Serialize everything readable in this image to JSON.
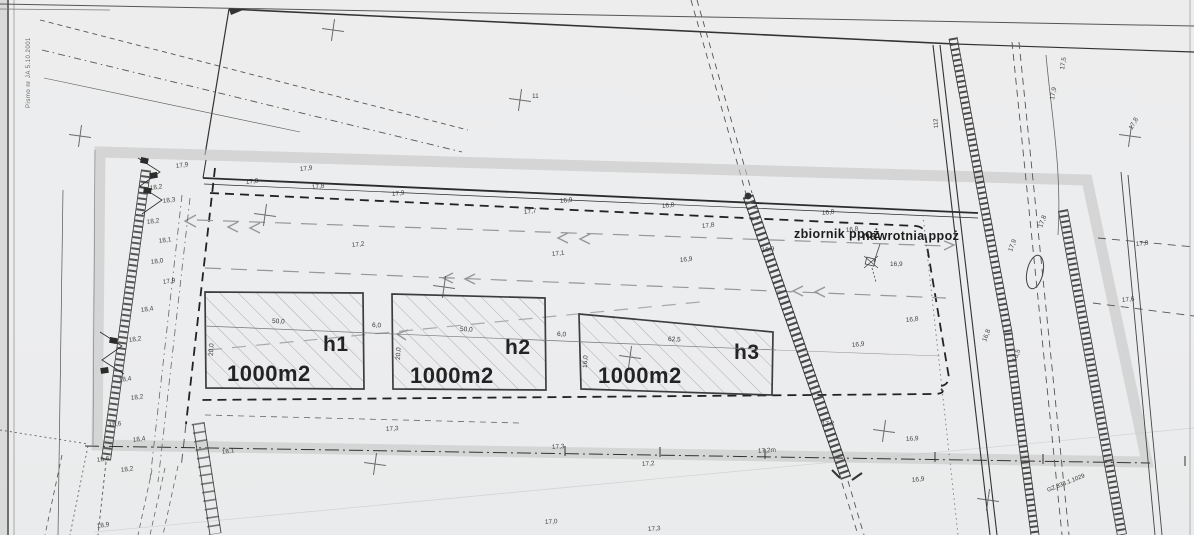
{
  "document": {
    "kind": "scanned site development plan",
    "side_note": "Pismo nr JA 5.10.2001"
  },
  "annotations": {
    "zbiornik": "zbiornik ppoż",
    "nawrotnia": "nawrotnia ppoż",
    "track_number": "112",
    "parcel_code": "GZ 838.1.1029"
  },
  "buildings": [
    {
      "id": "h1",
      "area": "1000m2",
      "width": "50,0",
      "depth": "20,0"
    },
    {
      "id": "h2",
      "area": "1000m2",
      "width": "50,0",
      "depth": "20,0"
    },
    {
      "id": "h3",
      "area": "1000m2",
      "width": "62,5",
      "depth": "16,0"
    }
  ],
  "dimensions": {
    "gaps": [
      "6,0",
      "6,0"
    ]
  },
  "colors": {
    "paper": "#ededee",
    "ink": "#2b2b2b",
    "highlight_band": "#c7c7c7",
    "flow_arrow_gray": "#979797",
    "hatch": "#9fa4a8"
  },
  "spots": [
    {
      "x": 246,
      "y": 184,
      "v": "17,8",
      "r": -6
    },
    {
      "x": 312,
      "y": 189,
      "v": "17,8",
      "r": -6
    },
    {
      "x": 392,
      "y": 196,
      "v": "17,9",
      "r": -6
    },
    {
      "x": 300,
      "y": 171,
      "v": "17,9",
      "r": -6
    },
    {
      "x": 560,
      "y": 203,
      "v": "16,9",
      "r": -6
    },
    {
      "x": 662,
      "y": 208,
      "v": "16,8",
      "r": -6
    },
    {
      "x": 822,
      "y": 215,
      "v": "16,8",
      "r": -6
    },
    {
      "x": 524,
      "y": 214,
      "v": "17,7",
      "r": -6
    },
    {
      "x": 702,
      "y": 228,
      "v": "17,8",
      "r": -6
    },
    {
      "x": 352,
      "y": 247,
      "v": "17,2",
      "r": -6
    },
    {
      "x": 552,
      "y": 256,
      "v": "17,1",
      "r": -6
    },
    {
      "x": 680,
      "y": 262,
      "v": "16,9",
      "r": -6
    },
    {
      "x": 762,
      "y": 252,
      "v": "16,9",
      "r": -6
    },
    {
      "x": 846,
      "y": 232,
      "v": "16,8",
      "r": -6
    },
    {
      "x": 890,
      "y": 266,
      "v": "16,9",
      "r": 0
    },
    {
      "x": 906,
      "y": 322,
      "v": "16,8",
      "r": -6
    },
    {
      "x": 852,
      "y": 347,
      "v": "16,9",
      "r": -6
    },
    {
      "x": 912,
      "y": 482,
      "v": "16,9",
      "r": -6
    },
    {
      "x": 150,
      "y": 190,
      "v": "18,2",
      "r": -8
    },
    {
      "x": 163,
      "y": 203,
      "v": "18,3",
      "r": -8
    },
    {
      "x": 147,
      "y": 224,
      "v": "18,2",
      "r": -8
    },
    {
      "x": 159,
      "y": 243,
      "v": "18,1",
      "r": -8
    },
    {
      "x": 151,
      "y": 264,
      "v": "18,0",
      "r": -8
    },
    {
      "x": 163,
      "y": 284,
      "v": "17,9",
      "r": -8
    },
    {
      "x": 141,
      "y": 312,
      "v": "18,4",
      "r": -8
    },
    {
      "x": 129,
      "y": 342,
      "v": "18,2",
      "r": -8
    },
    {
      "x": 119,
      "y": 382,
      "v": "18,4",
      "r": -8
    },
    {
      "x": 131,
      "y": 400,
      "v": "18,2",
      "r": -8
    },
    {
      "x": 109,
      "y": 427,
      "v": "18,6",
      "r": -8
    },
    {
      "x": 133,
      "y": 442,
      "v": "18,4",
      "r": -8
    },
    {
      "x": 97,
      "y": 462,
      "v": "18,6",
      "r": -8
    },
    {
      "x": 121,
      "y": 472,
      "v": "18,2",
      "r": -8
    },
    {
      "x": 97,
      "y": 528,
      "v": "18,9",
      "r": -8
    },
    {
      "x": 386,
      "y": 431,
      "v": "17,3",
      "r": -4
    },
    {
      "x": 552,
      "y": 449,
      "v": "17,3",
      "r": -4
    },
    {
      "x": 758,
      "y": 453,
      "v": "17,2m",
      "r": -4
    },
    {
      "x": 822,
      "y": 426,
      "v": "17,2",
      "r": -4
    },
    {
      "x": 642,
      "y": 466,
      "v": "17,2",
      "r": -4
    },
    {
      "x": 906,
      "y": 441,
      "v": "16,9",
      "r": -4
    },
    {
      "x": 545,
      "y": 524,
      "v": "17,0",
      "r": -4
    },
    {
      "x": 648,
      "y": 531,
      "v": "17,3",
      "r": -4
    },
    {
      "x": 1012,
      "y": 252,
      "v": "17,9",
      "r": -70
    },
    {
      "x": 1042,
      "y": 228,
      "v": "17,8",
      "r": -70
    },
    {
      "x": 986,
      "y": 342,
      "v": "16,8",
      "r": -70
    },
    {
      "x": 1016,
      "y": 362,
      "v": "16,5",
      "r": -70
    },
    {
      "x": 1064,
      "y": 70,
      "v": "17,5",
      "r": -80
    },
    {
      "x": 1054,
      "y": 100,
      "v": "17,9",
      "r": -80
    },
    {
      "x": 1136,
      "y": 246,
      "v": "17,8",
      "r": -6
    },
    {
      "x": 1122,
      "y": 302,
      "v": "17,6",
      "r": -6
    },
    {
      "x": 532,
      "y": 98,
      "v": "11",
      "r": 0
    },
    {
      "x": 1132,
      "y": 130,
      "v": "17,8",
      "r": -60
    },
    {
      "x": 176,
      "y": 168,
      "v": "17,9",
      "r": -8
    },
    {
      "x": 222,
      "y": 454,
      "v": "18,1",
      "r": -8
    }
  ],
  "crosses": [
    {
      "x": 333,
      "y": 30
    },
    {
      "x": 520,
      "y": 100
    },
    {
      "x": 80,
      "y": 136
    },
    {
      "x": 1130,
      "y": 136
    },
    {
      "x": 265,
      "y": 215
    },
    {
      "x": 444,
      "y": 287
    },
    {
      "x": 630,
      "y": 357
    },
    {
      "x": 884,
      "y": 431
    },
    {
      "x": 375,
      "y": 464
    },
    {
      "x": 988,
      "y": 500
    }
  ]
}
